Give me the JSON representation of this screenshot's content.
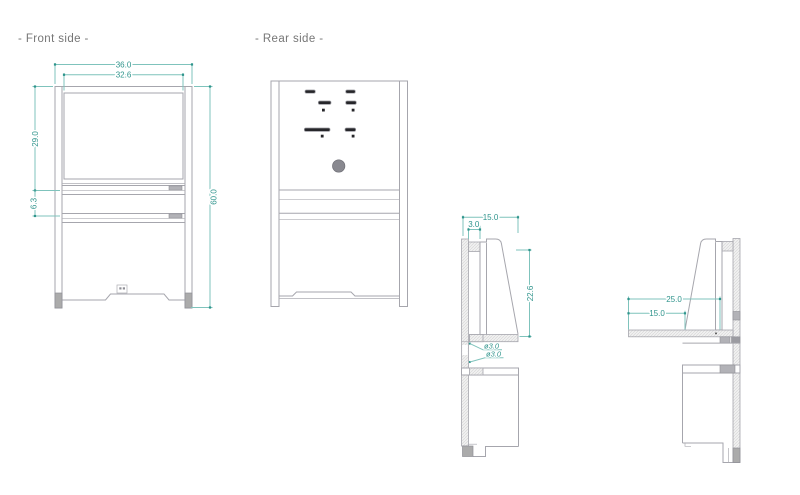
{
  "front": {
    "title": "- Front side -",
    "dims": {
      "outer_width": "36.0",
      "inner_width": "32.6",
      "upper_height": "29.0",
      "shelf_gap": "6.3",
      "total_height": "60.0"
    }
  },
  "rear": {
    "title": "- Rear side -"
  },
  "side_left": {
    "dims": {
      "top_depth": "15.0",
      "rear_thickness": "3.0",
      "bracket_height": "22.6",
      "hole_upper": "ø3.0",
      "hole_lower": "ø3.0"
    }
  },
  "side_right": {
    "dims": {
      "desk_total_depth": "25.0",
      "desk_front_depth": "15.0"
    }
  },
  "colors": {
    "dimension_line": "#7fc3bc",
    "dimension_text": "#2f948c",
    "outline": "#a6a6ad",
    "title_text": "#767676",
    "slot_fill": "#26262a",
    "hole_fill": "#898990"
  }
}
